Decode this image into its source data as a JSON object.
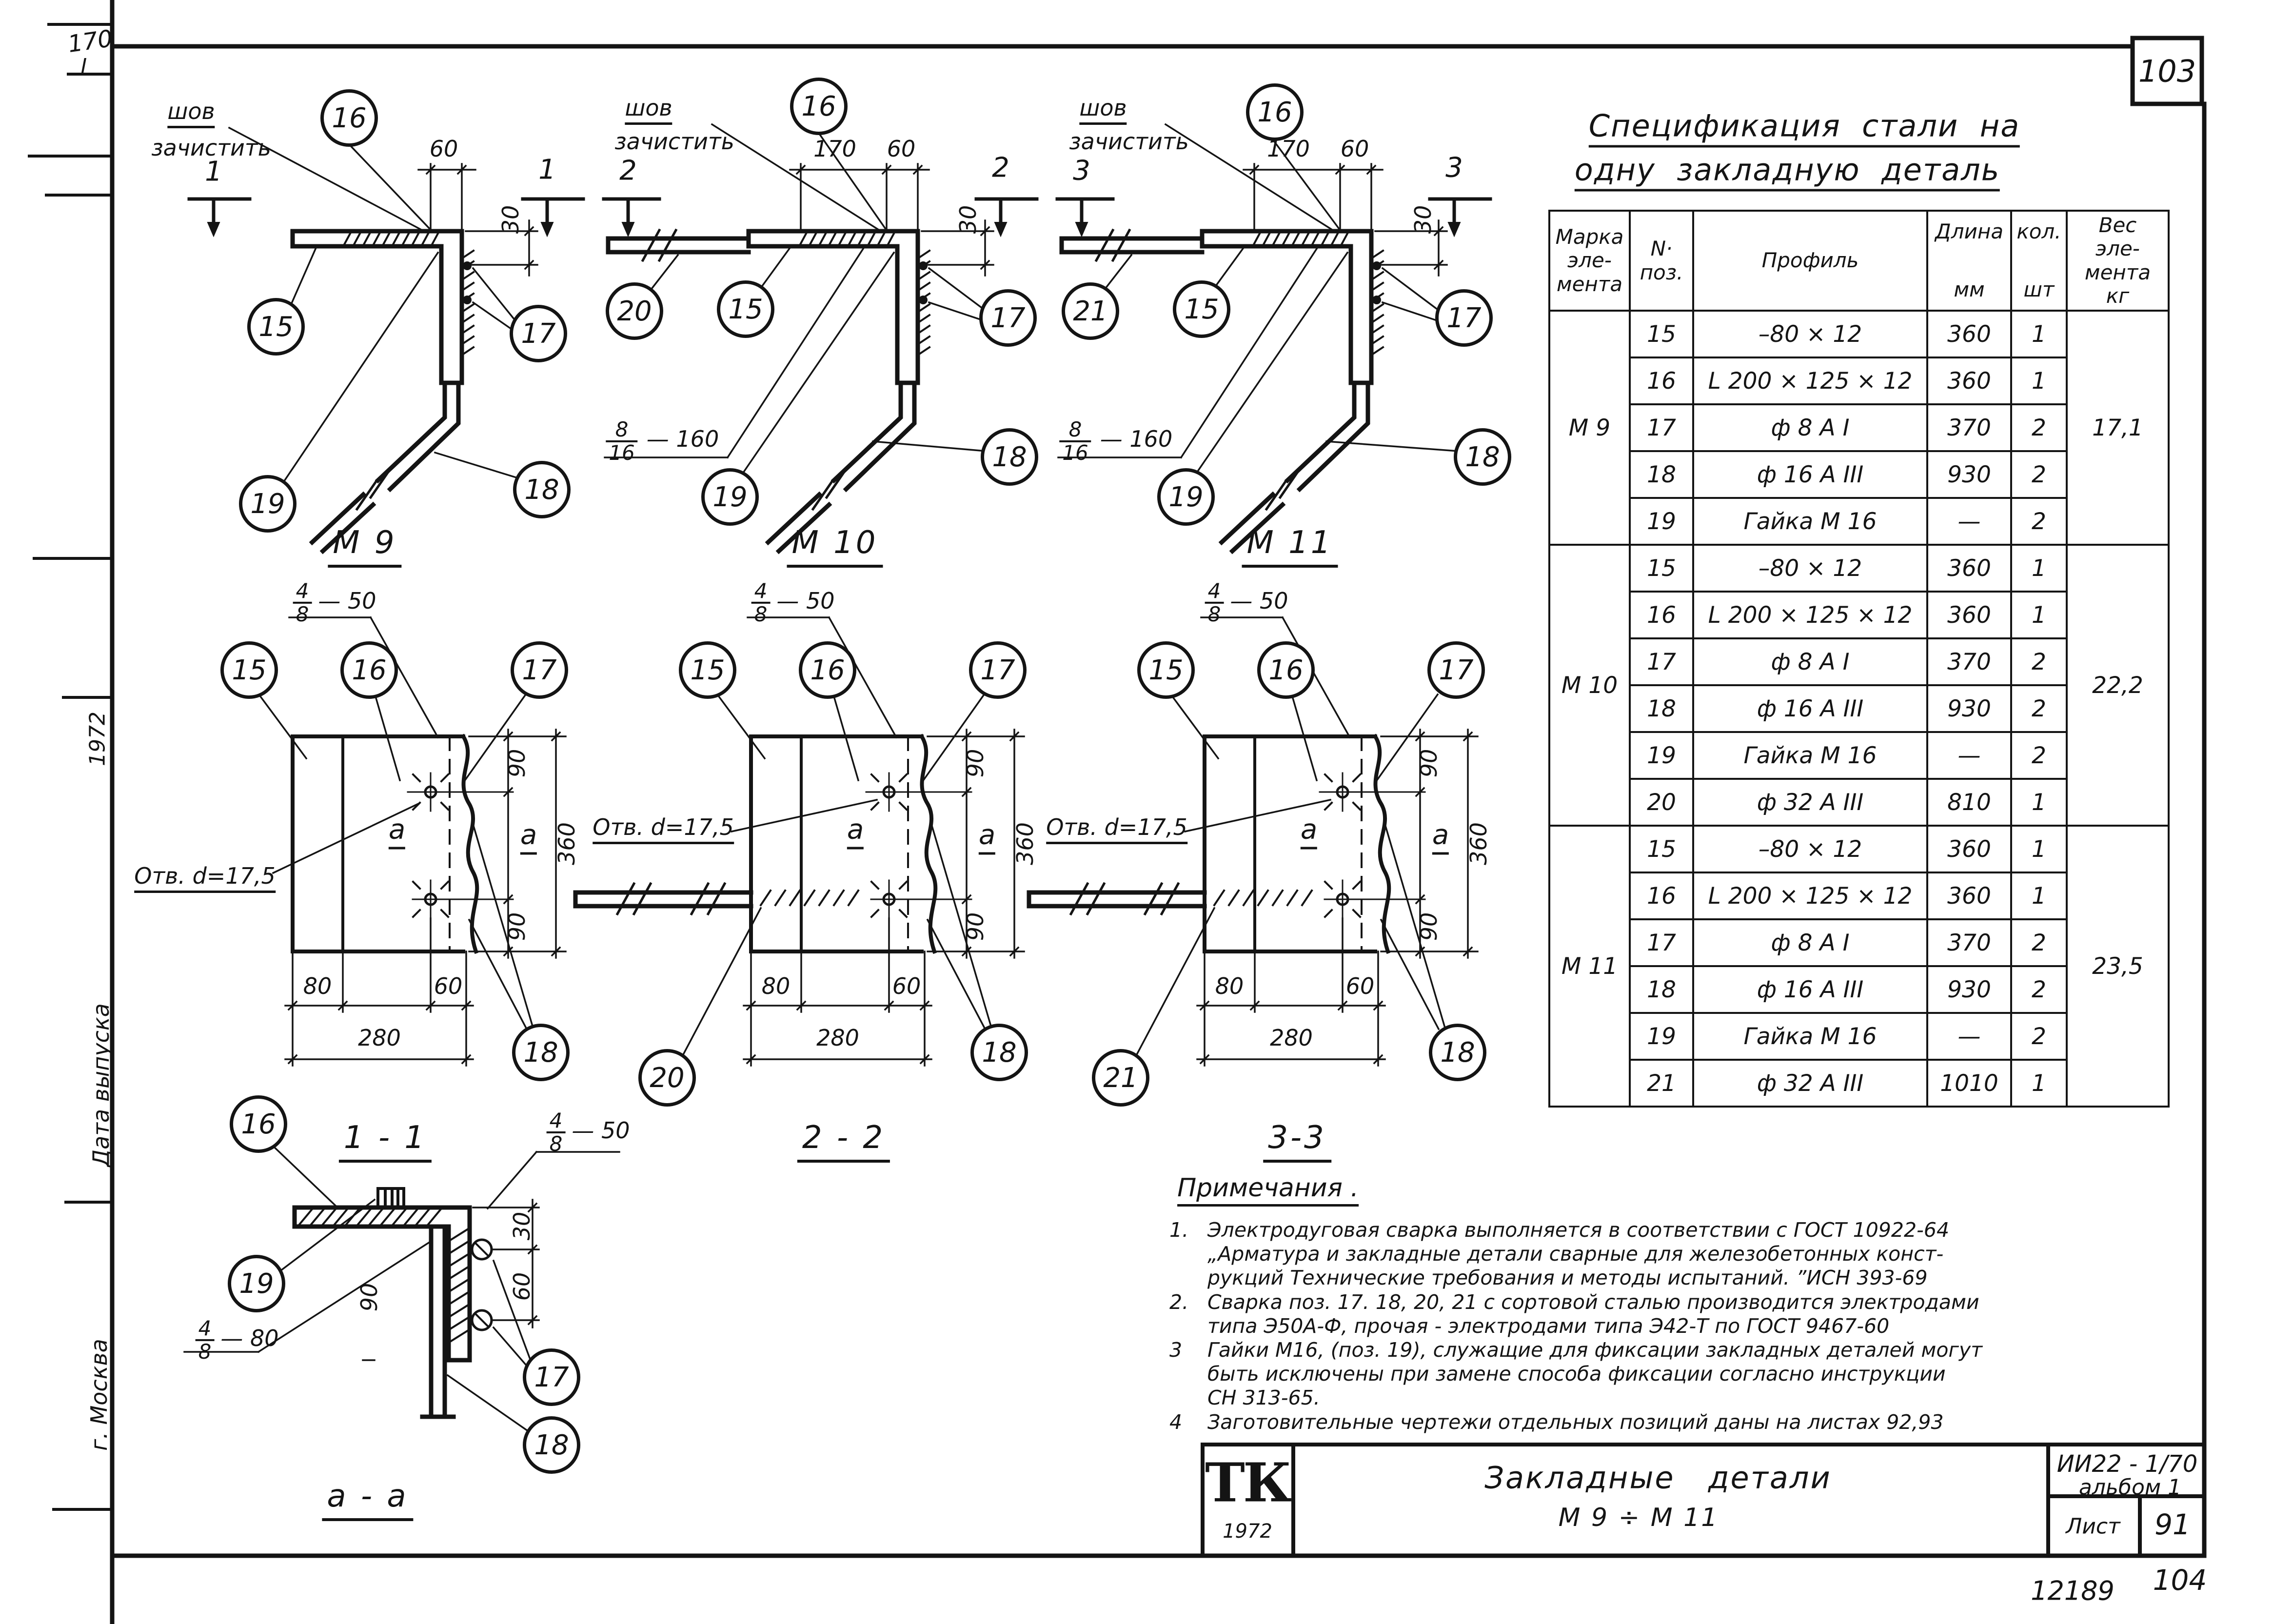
{
  "page": {
    "number_top": "103",
    "stamp_left": "12189",
    "stamp_right": "104",
    "margin_note": "170",
    "margin_note2": "I",
    "margin_year": "1972",
    "margin_date": "Дата выпуска",
    "margin_city": "г. Москва"
  },
  "spec_table": {
    "title_line1": "Спецификация  стали  на",
    "title_line2": "одну  закладную  деталь",
    "headers": {
      "mark": "Марка\nэле-\nмента",
      "pos": "N·\nпоз.",
      "profile": "Профиль",
      "length": "Длина",
      "length_unit": "мм",
      "qty": "кол.",
      "qty_unit": "шт",
      "weight": "Вес\nэле-\nмента\nкг"
    },
    "groups": [
      {
        "mark": "М 9",
        "weight": "17,1",
        "rows": [
          {
            "pos": "15",
            "profile": "–80 × 12",
            "len": "360",
            "qty": "1"
          },
          {
            "pos": "16",
            "profile": "L 200 × 125 × 12",
            "len": "360",
            "qty": "1"
          },
          {
            "pos": "17",
            "profile": "ф 8 А I",
            "len": "370",
            "qty": "2"
          },
          {
            "pos": "18",
            "profile": "ф 16 А III",
            "len": "930",
            "qty": "2"
          },
          {
            "pos": "19",
            "profile": "Гайка М 16",
            "len": "—",
            "qty": "2"
          }
        ]
      },
      {
        "mark": "М 10",
        "weight": "22,2",
        "rows": [
          {
            "pos": "15",
            "profile": "–80 × 12",
            "len": "360",
            "qty": "1"
          },
          {
            "pos": "16",
            "profile": "L 200 × 125 × 12",
            "len": "360",
            "qty": "1"
          },
          {
            "pos": "17",
            "profile": "ф 8 А I",
            "len": "370",
            "qty": "2"
          },
          {
            "pos": "18",
            "profile": "ф 16 А III",
            "len": "930",
            "qty": "2"
          },
          {
            "pos": "19",
            "profile": "Гайка М 16",
            "len": "—",
            "qty": "2"
          },
          {
            "pos": "20",
            "profile": "ф 32 А III",
            "len": "810",
            "qty": "1"
          }
        ]
      },
      {
        "mark": "М 11",
        "weight": "23,5",
        "rows": [
          {
            "pos": "15",
            "profile": "–80 × 12",
            "len": "360",
            "qty": "1"
          },
          {
            "pos": "16",
            "profile": "L 200 × 125 × 12",
            "len": "360",
            "qty": "1"
          },
          {
            "pos": "17",
            "profile": "ф 8 А I",
            "len": "370",
            "qty": "2"
          },
          {
            "pos": "18",
            "profile": "ф 16 А III",
            "len": "930",
            "qty": "2"
          },
          {
            "pos": "19",
            "profile": "Гайка М 16",
            "len": "—",
            "qty": "2"
          },
          {
            "pos": "21",
            "profile": "ф 32 А III",
            "len": "1010",
            "qty": "1"
          }
        ]
      }
    ]
  },
  "callouts": {
    "15": "15",
    "16": "16",
    "17": "17",
    "18": "18",
    "19": "19",
    "20": "20",
    "21": "21"
  },
  "drawings": {
    "weld_note1": "шов",
    "weld_note2": "зачистить",
    "hole_label": "Отв. d=17,5",
    "axis_label": "а",
    "m9_title": "М 9",
    "m10_title": "М 10",
    "m11_title": "М 11",
    "plan1_title": "1 - 1",
    "plan2_title": "2 - 2",
    "plan3_title": "3-3",
    "section_title": "а - а",
    "marker1": "1",
    "marker2": "2",
    "marker3": "3",
    "dims": {
      "d30": "30",
      "d60": "60",
      "d80": "80",
      "d90": "90",
      "d170": "170",
      "d280": "280",
      "d360": "360"
    },
    "welds": {
      "f4": "4",
      "f8": "8",
      "f16": "16",
      "n50": "— 50",
      "n80": "— 80",
      "n160": "— 160"
    }
  },
  "notes": {
    "heading": "Примечания .",
    "items": [
      {
        "num": "1.",
        "text": "Электродуговая  сварка  выполняется  в  соответствии  с  ГОСТ 10922-64\n„Арматура  и  закладные  детали  сварные  для  железобетонных  конст-\nрукций   Технические  требования  и  методы  испытаний. ”ИСН 393-69"
      },
      {
        "num": "2.",
        "text": "Сварка  поз.  17. 18, 20, 21  с  сортовой  сталью  производится  электродами\nтипа  Э50А-Ф, прочая - электродами  типа  Э42-Т  по  ГОСТ 9467-60"
      },
      {
        "num": "3",
        "text": "Гайки  М16,  (поз. 19),  служащие  для  фиксации  закладных  деталей  могут\nбыть  исключены  при  замене  способа  фиксации  согласно  инструкции\nСН 313-65."
      },
      {
        "num": "4",
        "text": "Заготовительные  чертежи  отдельных  позиций  даны  на  листах  92,93"
      }
    ]
  },
  "title_block": {
    "logo": "ТК",
    "logo_year": "1972",
    "title_line1": "Закладные   детали",
    "title_line2": "М 9 ÷ М 11",
    "doc_number": "ИИ22 - 1/70",
    "album": "альбом 1",
    "sheet_label": "Лист",
    "sheet_number": "91"
  }
}
